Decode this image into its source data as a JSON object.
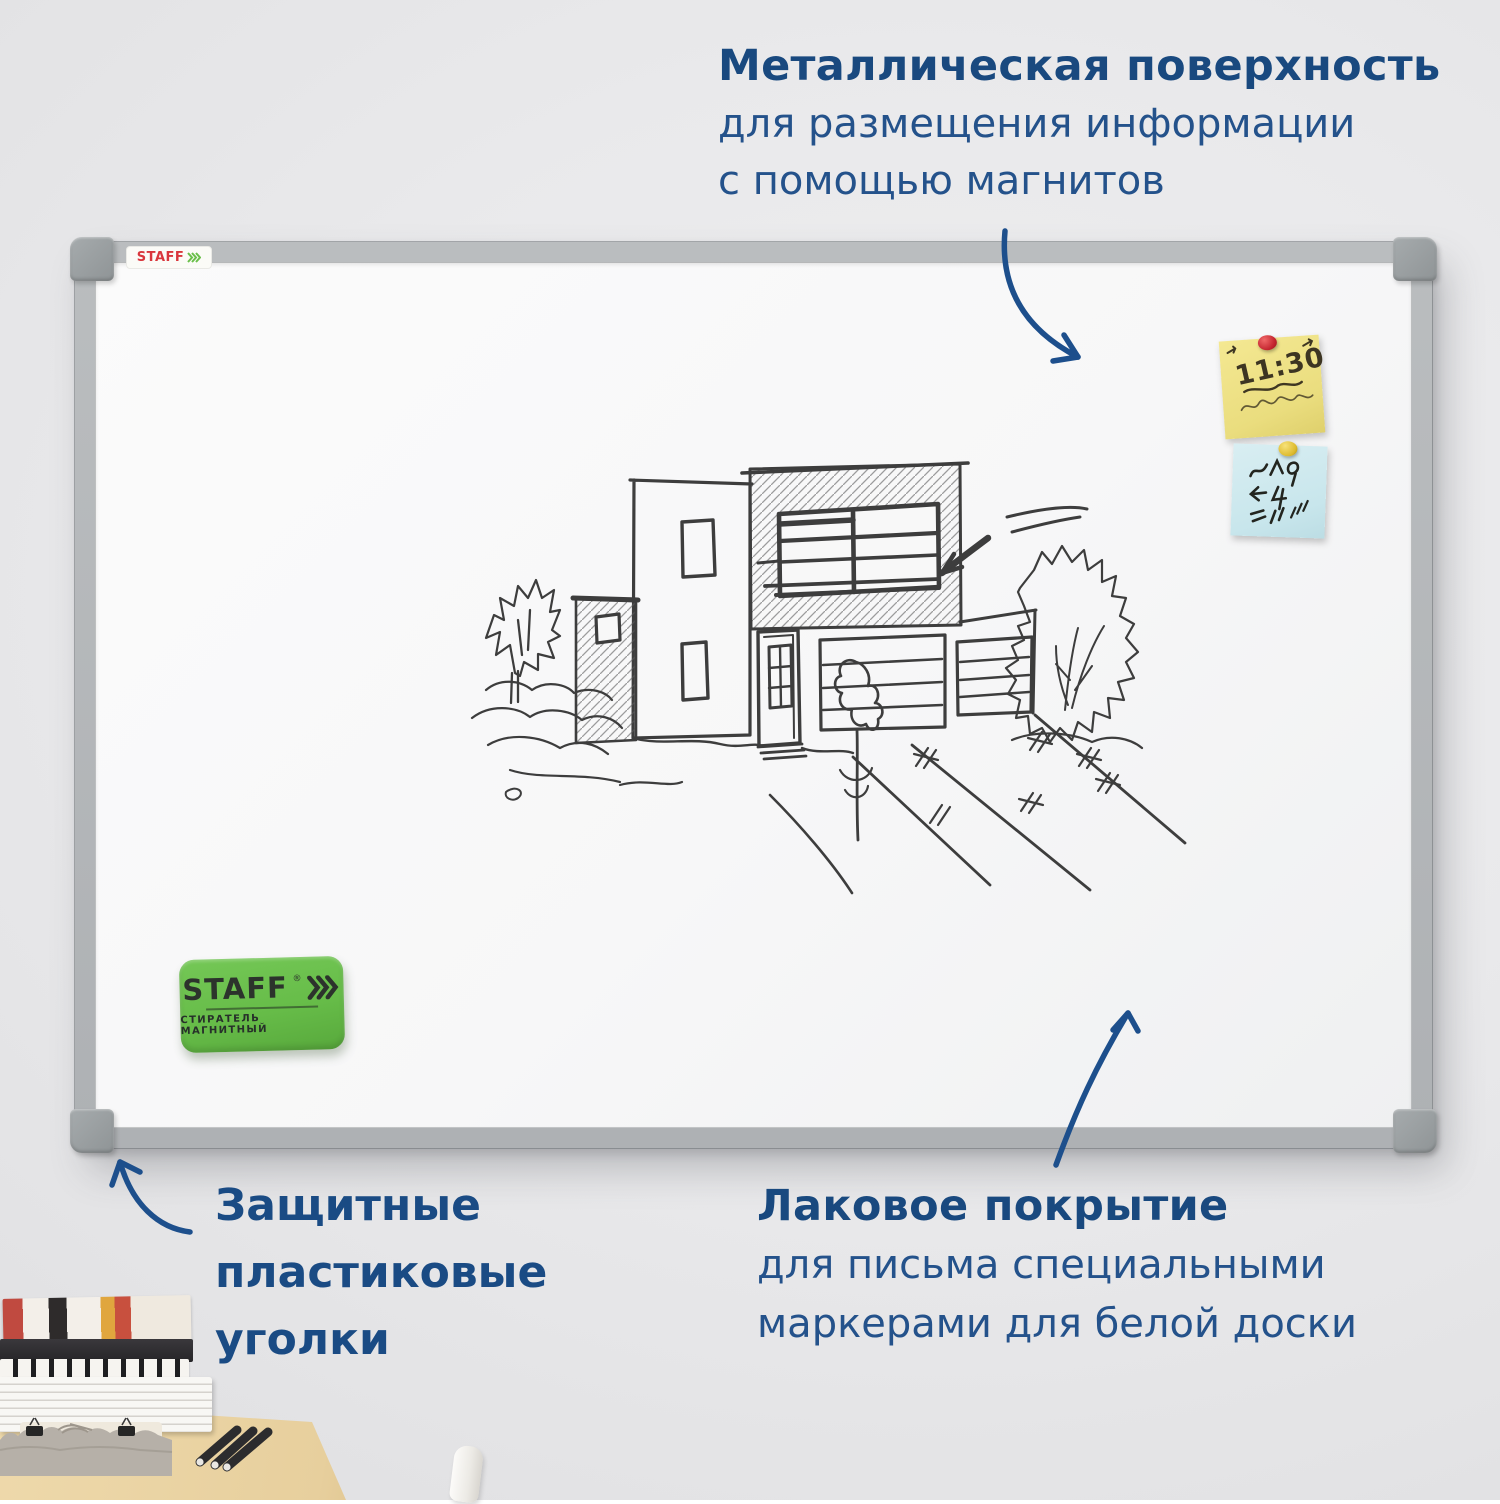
{
  "callouts": {
    "magnetic": {
      "title": "Металлическая поверхность",
      "lines": [
        "для размещения информации",
        "с помощью магнитов"
      ]
    },
    "corners": {
      "lines": [
        "Защитные",
        "пластиковые",
        "уголки"
      ]
    },
    "lacquer": {
      "title": "Лаковое покрытие",
      "lines": [
        "для письма специальными",
        "маркерами для белой доски"
      ]
    }
  },
  "board": {
    "frame_sticker_brand": "STAFF",
    "note_yellow_text": "11:30",
    "eraser": {
      "brand": "STAFF",
      "reg": "®",
      "label": "СТИРАТЕЛЬ МАГНИТНЫЙ"
    }
  },
  "colors": {
    "accent_blue": "#1d508e",
    "arrow_blue": "#1d4f8c",
    "eraser_green": "#68be4a",
    "staff_red": "#d9363c",
    "note_yellow": "#efe287",
    "note_blue": "#cfe9ed",
    "frame_gray": "#b4b7b9",
    "wall_gray": "#e9e9eb",
    "desk_wood": "#e9d2a2",
    "sketch_ink": "#242424"
  }
}
